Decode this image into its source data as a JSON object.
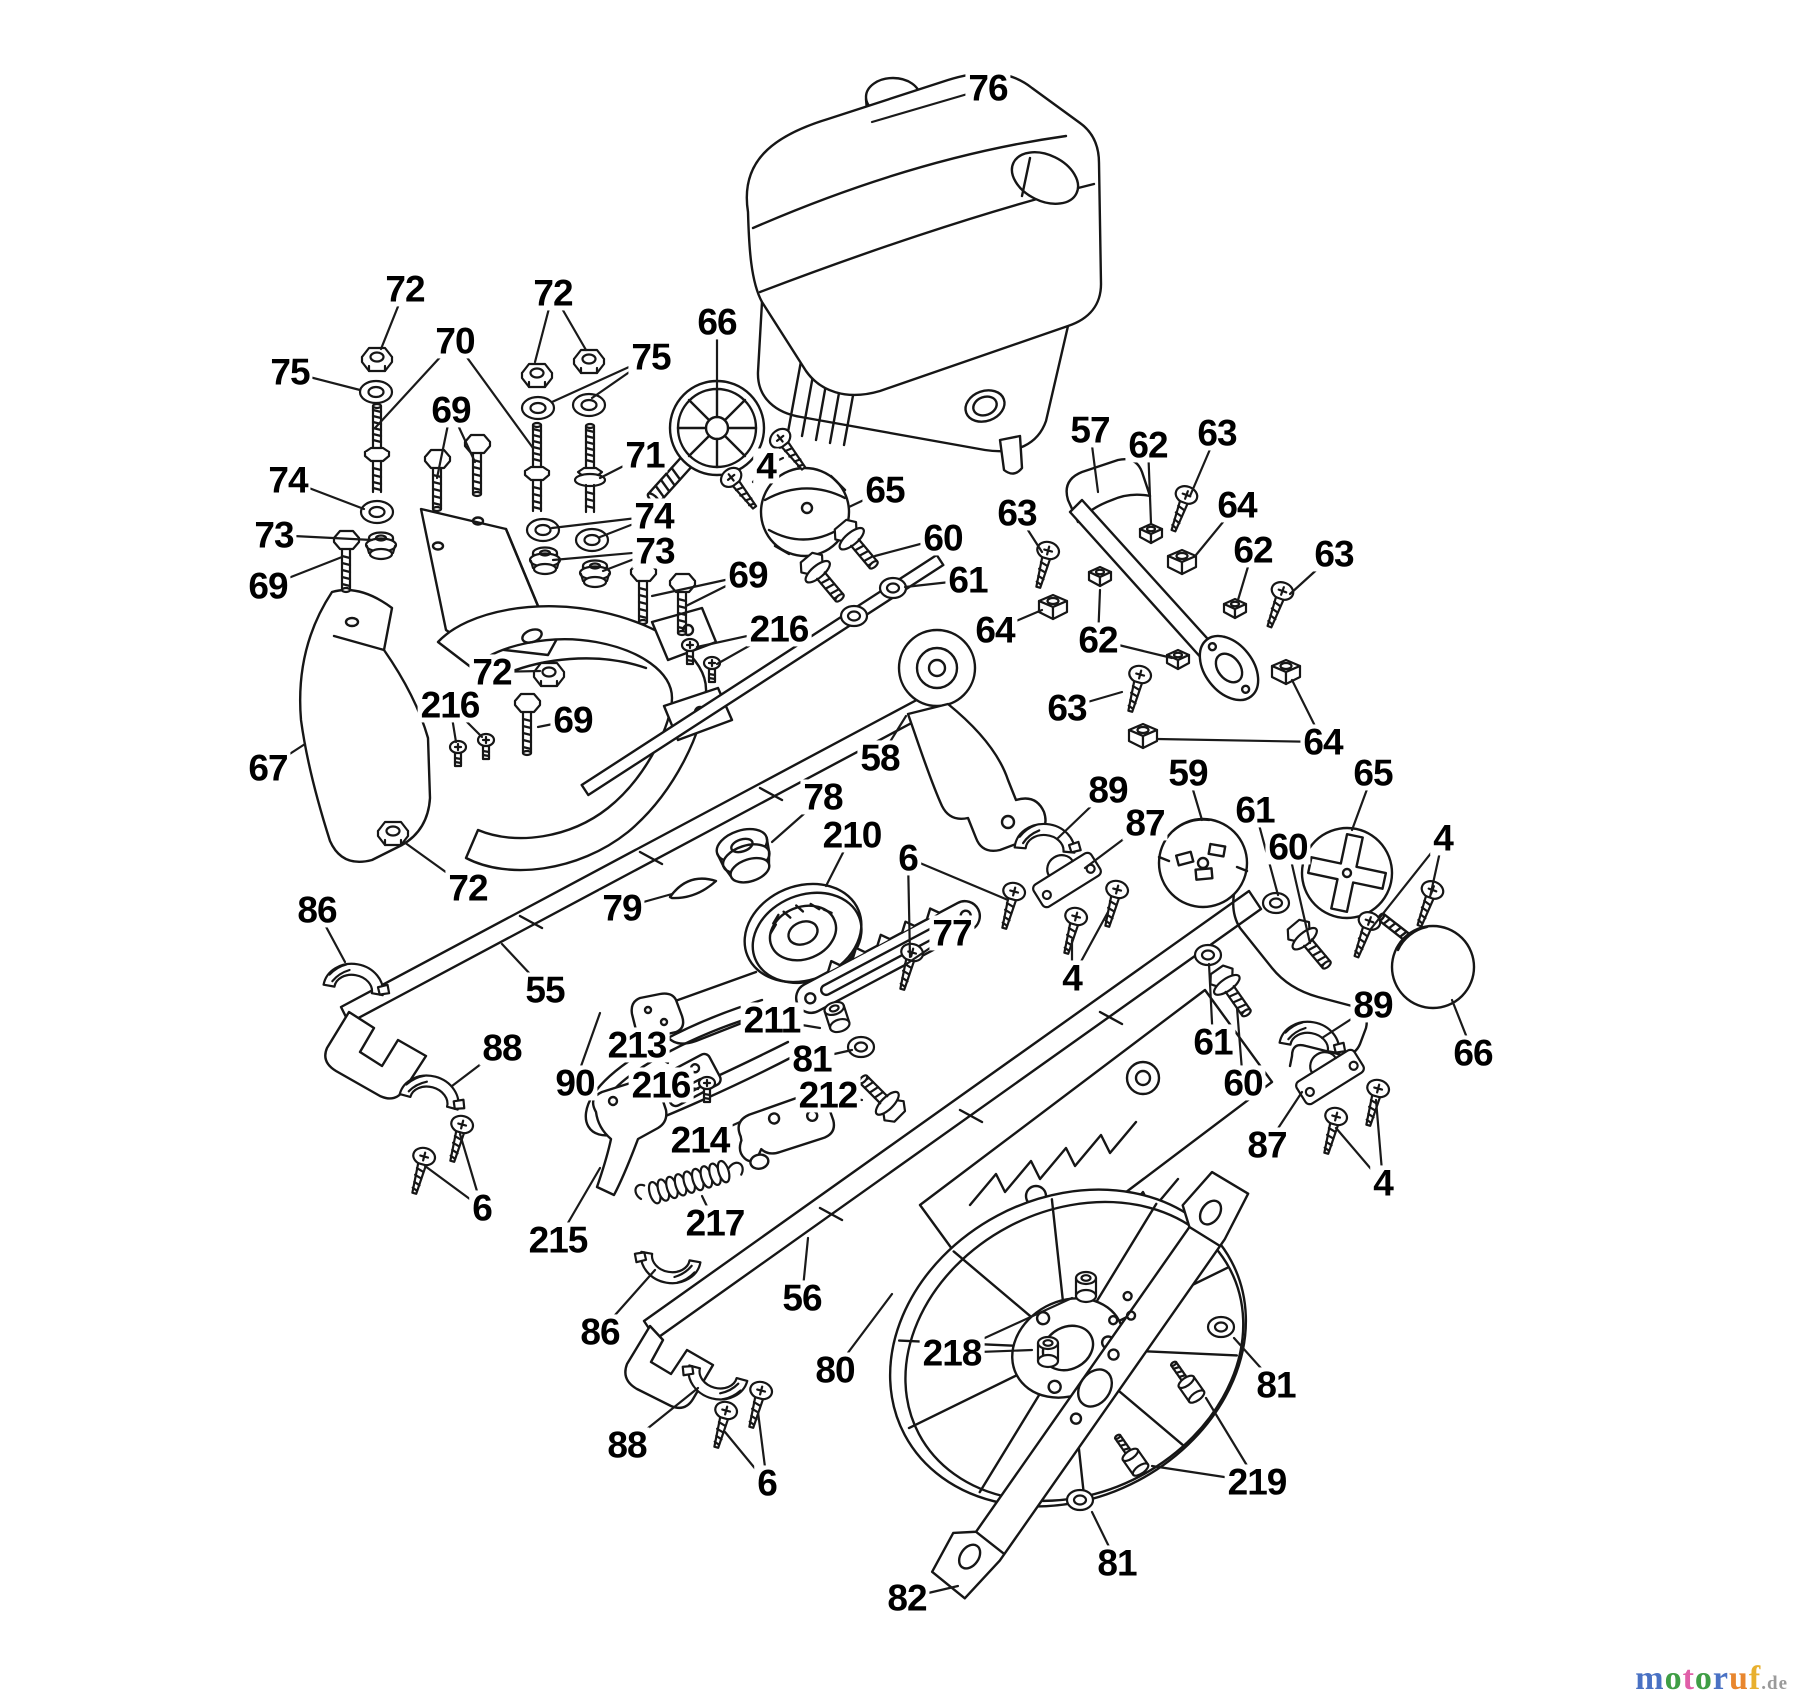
{
  "canvas": {
    "width": 1800,
    "height": 1704,
    "background": "#ffffff",
    "ink": "#161616"
  },
  "watermark": {
    "suffix": ".de",
    "suffix_color": "#9a9a9a",
    "letters": [
      {
        "ch": "m",
        "color": "#4a72c4"
      },
      {
        "ch": "o",
        "color": "#3f9e45"
      },
      {
        "ch": "t",
        "color": "#e05fa8"
      },
      {
        "ch": "o",
        "color": "#3f9e45"
      },
      {
        "ch": "r",
        "color": "#4a72c4"
      },
      {
        "ch": "u",
        "color": "#e8862e"
      },
      {
        "ch": "f",
        "color": "#e8b02e"
      }
    ]
  },
  "callouts": [
    {
      "n": "76",
      "x": 988,
      "y": 88,
      "t": [
        [
          872,
          122
        ]
      ]
    },
    {
      "n": "72",
      "x": 405,
      "y": 289,
      "t": [
        [
          381,
          349
        ]
      ]
    },
    {
      "n": "75",
      "x": 290,
      "y": 372,
      "t": [
        [
          360,
          390
        ]
      ]
    },
    {
      "n": "70",
      "x": 455,
      "y": 341,
      "t": [
        [
          375,
          428
        ],
        [
          533,
          448
        ]
      ]
    },
    {
      "n": "72",
      "x": 553,
      "y": 293,
      "t": [
        [
          535,
          362
        ],
        [
          586,
          350
        ]
      ]
    },
    {
      "n": "75",
      "x": 651,
      "y": 357,
      "t": [
        [
          552,
          402
        ],
        [
          592,
          398
        ]
      ]
    },
    {
      "n": "69",
      "x": 451,
      "y": 410,
      "t": [
        [
          437,
          478
        ],
        [
          475,
          462
        ]
      ]
    },
    {
      "n": "71",
      "x": 645,
      "y": 455,
      "t": [
        [
          600,
          478
        ]
      ]
    },
    {
      "n": "74",
      "x": 288,
      "y": 480,
      "t": [
        [
          364,
          509
        ]
      ]
    },
    {
      "n": "73",
      "x": 274,
      "y": 535,
      "t": [
        [
          372,
          540
        ]
      ]
    },
    {
      "n": "69",
      "x": 268,
      "y": 586,
      "t": [
        [
          342,
          557
        ]
      ]
    },
    {
      "n": "74",
      "x": 654,
      "y": 516,
      "t": [
        [
          600,
          537
        ],
        [
          552,
          528
        ]
      ]
    },
    {
      "n": "73",
      "x": 655,
      "y": 551,
      "t": [
        [
          603,
          571
        ],
        [
          553,
          560
        ]
      ]
    },
    {
      "n": "66",
      "x": 717,
      "y": 322,
      "t": [
        [
          717,
          388
        ]
      ]
    },
    {
      "n": "4",
      "x": 766,
      "y": 466,
      "t": [
        [
          753,
          482
        ],
        [
          783,
          458
        ]
      ]
    },
    {
      "n": "65",
      "x": 885,
      "y": 490,
      "t": [
        [
          849,
          507
        ]
      ]
    },
    {
      "n": "57",
      "x": 1090,
      "y": 430,
      "t": [
        [
          1098,
          492
        ]
      ]
    },
    {
      "n": "62",
      "x": 1148,
      "y": 445,
      "t": [
        [
          1151,
          523
        ]
      ]
    },
    {
      "n": "63",
      "x": 1217,
      "y": 433,
      "t": [
        [
          1190,
          496
        ]
      ]
    },
    {
      "n": "64",
      "x": 1237,
      "y": 505,
      "t": [
        [
          1196,
          555
        ]
      ]
    },
    {
      "n": "62",
      "x": 1253,
      "y": 550,
      "t": [
        [
          1238,
          600
        ]
      ]
    },
    {
      "n": "63",
      "x": 1334,
      "y": 554,
      "t": [
        [
          1290,
          594
        ]
      ]
    },
    {
      "n": "63",
      "x": 1017,
      "y": 513,
      "t": [
        [
          1042,
          552
        ]
      ]
    },
    {
      "n": "60",
      "x": 943,
      "y": 538,
      "t": [
        [
          875,
          556
        ]
      ]
    },
    {
      "n": "61",
      "x": 968,
      "y": 580,
      "t": [
        [
          905,
          587
        ]
      ]
    },
    {
      "n": "64",
      "x": 995,
      "y": 630,
      "t": [
        [
          1042,
          610
        ]
      ]
    },
    {
      "n": "62",
      "x": 1098,
      "y": 640,
      "t": [
        [
          1100,
          590
        ],
        [
          1172,
          658
        ]
      ]
    },
    {
      "n": "63",
      "x": 1067,
      "y": 708,
      "t": [
        [
          1122,
          692
        ]
      ]
    },
    {
      "n": "64",
      "x": 1323,
      "y": 742,
      "t": [
        [
          1292,
          680
        ],
        [
          1157,
          739
        ]
      ]
    },
    {
      "n": "67",
      "x": 268,
      "y": 768,
      "t": [
        [
          305,
          744
        ]
      ]
    },
    {
      "n": "72",
      "x": 492,
      "y": 672,
      "t": [
        [
          540,
          671
        ]
      ]
    },
    {
      "n": "216",
      "x": 450,
      "y": 705,
      "t": [
        [
          456,
          742
        ],
        [
          482,
          737
        ]
      ]
    },
    {
      "n": "69",
      "x": 573,
      "y": 720,
      "t": [
        [
          538,
          727
        ]
      ]
    },
    {
      "n": "69",
      "x": 748,
      "y": 575,
      "t": [
        [
          652,
          596
        ],
        [
          686,
          606
        ]
      ]
    },
    {
      "n": "216",
      "x": 779,
      "y": 629,
      "t": [
        [
          697,
          647
        ],
        [
          717,
          664
        ]
      ]
    },
    {
      "n": "72",
      "x": 468,
      "y": 888,
      "t": [
        [
          404,
          842
        ]
      ]
    },
    {
      "n": "86",
      "x": 317,
      "y": 910,
      "t": [
        [
          345,
          962
        ]
      ]
    },
    {
      "n": "79",
      "x": 622,
      "y": 908,
      "t": [
        [
          672,
          894
        ]
      ]
    },
    {
      "n": "55",
      "x": 545,
      "y": 990,
      "t": [
        [
          502,
          944
        ]
      ]
    },
    {
      "n": "58",
      "x": 880,
      "y": 758,
      "t": [
        [
          906,
          716
        ]
      ]
    },
    {
      "n": "78",
      "x": 823,
      "y": 797,
      "t": [
        [
          772,
          842
        ]
      ]
    },
    {
      "n": "210",
      "x": 852,
      "y": 835,
      "t": [
        [
          826,
          886
        ]
      ]
    },
    {
      "n": "6",
      "x": 908,
      "y": 858,
      "t": [
        [
          910,
          957
        ],
        [
          1008,
          900
        ]
      ]
    },
    {
      "n": "77",
      "x": 952,
      "y": 933,
      "t": [
        [
          905,
          965
        ]
      ]
    },
    {
      "n": "211",
      "x": 772,
      "y": 1020,
      "t": [
        [
          820,
          1028
        ]
      ]
    },
    {
      "n": "81",
      "x": 812,
      "y": 1059,
      "t": [
        [
          852,
          1050
        ]
      ]
    },
    {
      "n": "213",
      "x": 637,
      "y": 1045,
      "t": [
        [
          668,
          1063
        ]
      ]
    },
    {
      "n": "90",
      "x": 575,
      "y": 1083,
      "t": [
        [
          600,
          1013
        ]
      ]
    },
    {
      "n": "216",
      "x": 661,
      "y": 1085,
      "t": [
        [
          698,
          1089
        ]
      ]
    },
    {
      "n": "212",
      "x": 828,
      "y": 1095,
      "t": [
        [
          862,
          1100
        ]
      ]
    },
    {
      "n": "214",
      "x": 700,
      "y": 1140,
      "t": [
        [
          740,
          1122
        ]
      ]
    },
    {
      "n": "215",
      "x": 558,
      "y": 1240,
      "t": [
        [
          600,
          1168
        ]
      ]
    },
    {
      "n": "217",
      "x": 715,
      "y": 1223,
      "t": [
        [
          702,
          1196
        ]
      ]
    },
    {
      "n": "6",
      "x": 482,
      "y": 1208,
      "t": [
        [
          425,
          1166
        ],
        [
          460,
          1134
        ]
      ]
    },
    {
      "n": "86",
      "x": 600,
      "y": 1332,
      "t": [
        [
          655,
          1270
        ]
      ]
    },
    {
      "n": "56",
      "x": 802,
      "y": 1298,
      "t": [
        [
          808,
          1238
        ]
      ]
    },
    {
      "n": "80",
      "x": 835,
      "y": 1370,
      "t": [
        [
          892,
          1294
        ]
      ]
    },
    {
      "n": "218",
      "x": 952,
      "y": 1353,
      "t": [
        [
          1032,
          1350
        ],
        [
          1072,
          1298
        ]
      ]
    },
    {
      "n": "88",
      "x": 502,
      "y": 1048,
      "t": [
        [
          452,
          1086
        ]
      ]
    },
    {
      "n": "88",
      "x": 627,
      "y": 1445,
      "t": [
        [
          698,
          1388
        ]
      ]
    },
    {
      "n": "6",
      "x": 767,
      "y": 1483,
      "t": [
        [
          725,
          1432
        ],
        [
          758,
          1412
        ]
      ]
    },
    {
      "n": "82",
      "x": 907,
      "y": 1598,
      "t": [
        [
          958,
          1586
        ]
      ]
    },
    {
      "n": "81",
      "x": 1276,
      "y": 1385,
      "t": [
        [
          1234,
          1338
        ]
      ]
    },
    {
      "n": "219",
      "x": 1257,
      "y": 1482,
      "t": [
        [
          1206,
          1398
        ],
        [
          1152,
          1466
        ]
      ]
    },
    {
      "n": "81",
      "x": 1117,
      "y": 1563,
      "t": [
        [
          1092,
          1512
        ]
      ]
    },
    {
      "n": "59",
      "x": 1188,
      "y": 773,
      "t": [
        [
          1202,
          820
        ]
      ]
    },
    {
      "n": "89",
      "x": 1108,
      "y": 790,
      "t": [
        [
          1058,
          838
        ]
      ]
    },
    {
      "n": "87",
      "x": 1145,
      "y": 823,
      "t": [
        [
          1085,
          868
        ]
      ]
    },
    {
      "n": "61",
      "x": 1255,
      "y": 810,
      "t": [
        [
          1278,
          895
        ]
      ]
    },
    {
      "n": "60",
      "x": 1288,
      "y": 847,
      "t": [
        [
          1310,
          943
        ]
      ]
    },
    {
      "n": "65",
      "x": 1373,
      "y": 773,
      "t": [
        [
          1352,
          830
        ]
      ]
    },
    {
      "n": "4",
      "x": 1443,
      "y": 838,
      "t": [
        [
          1430,
          897
        ],
        [
          1370,
          930
        ]
      ]
    },
    {
      "n": "4",
      "x": 1072,
      "y": 978,
      "t": [
        [
          1072,
          940
        ],
        [
          1108,
          912
        ]
      ]
    },
    {
      "n": "61",
      "x": 1213,
      "y": 1042,
      "t": [
        [
          1209,
          964
        ]
      ]
    },
    {
      "n": "60",
      "x": 1243,
      "y": 1083,
      "t": [
        [
          1237,
          1008
        ]
      ]
    },
    {
      "n": "89",
      "x": 1373,
      "y": 1005,
      "t": [
        [
          1322,
          1038
        ]
      ]
    },
    {
      "n": "87",
      "x": 1267,
      "y": 1145,
      "t": [
        [
          1302,
          1092
        ]
      ]
    },
    {
      "n": "4",
      "x": 1383,
      "y": 1183,
      "t": [
        [
          1336,
          1128
        ],
        [
          1376,
          1100
        ]
      ]
    },
    {
      "n": "66",
      "x": 1473,
      "y": 1053,
      "t": [
        [
          1452,
          1000
        ]
      ]
    }
  ],
  "fasteners": [
    {
      "t": "hexnut",
      "x": 377,
      "y": 360,
      "r": 0
    },
    {
      "t": "hexnut",
      "x": 537,
      "y": 376,
      "r": 0
    },
    {
      "t": "hexnut",
      "x": 589,
      "y": 362,
      "r": 0
    },
    {
      "t": "hexnut",
      "x": 549,
      "y": 675,
      "r": 0
    },
    {
      "t": "hexnut",
      "x": 393,
      "y": 834,
      "r": 0
    },
    {
      "t": "sqnut",
      "x": 1151,
      "y": 535,
      "r": 0
    },
    {
      "t": "sqnut",
      "x": 1235,
      "y": 610,
      "r": 0
    },
    {
      "t": "sqnut",
      "x": 1100,
      "y": 578,
      "r": 0
    },
    {
      "t": "sqnut",
      "x": 1178,
      "y": 661,
      "r": 0
    },
    {
      "t": "sqnut64",
      "x": 1182,
      "y": 564,
      "r": 0
    },
    {
      "t": "sqnut64",
      "x": 1053,
      "y": 609,
      "r": 0
    },
    {
      "t": "sqnut64",
      "x": 1286,
      "y": 674,
      "r": 0
    },
    {
      "t": "sqnut64",
      "x": 1143,
      "y": 738,
      "r": 0
    },
    {
      "t": "washer",
      "x": 376,
      "y": 392,
      "r": 0
    },
    {
      "t": "washer",
      "x": 538,
      "y": 408,
      "r": 0
    },
    {
      "t": "washer",
      "x": 589,
      "y": 405,
      "r": 0
    },
    {
      "t": "washer",
      "x": 543,
      "y": 530,
      "r": 0
    },
    {
      "t": "washer",
      "x": 592,
      "y": 540,
      "r": 0
    },
    {
      "t": "washer",
      "x": 377,
      "y": 512,
      "r": 0
    },
    {
      "t": "washer_s",
      "x": 893,
      "y": 588,
      "r": 0
    },
    {
      "t": "washer_s",
      "x": 854,
      "y": 616,
      "r": 0
    },
    {
      "t": "washer_s",
      "x": 1276,
      "y": 903,
      "r": 0
    },
    {
      "t": "washer_s",
      "x": 1208,
      "y": 955,
      "r": 0
    },
    {
      "t": "washer_s",
      "x": 861,
      "y": 1047,
      "r": 0
    },
    {
      "t": "washer_s",
      "x": 1221,
      "y": 1327,
      "r": 0
    },
    {
      "t": "washer_s",
      "x": 1080,
      "y": 1500,
      "r": 0
    },
    {
      "t": "grommet",
      "x": 381,
      "y": 547,
      "r": 0
    },
    {
      "t": "grommet",
      "x": 545,
      "y": 562,
      "r": 0
    },
    {
      "t": "grommet",
      "x": 595,
      "y": 575,
      "r": 0
    },
    {
      "t": "bushing",
      "x": 1086,
      "y": 1287,
      "r": 0
    },
    {
      "t": "bushing",
      "x": 1048,
      "y": 1352,
      "r": 0
    },
    {
      "t": "bushing",
      "x": 837,
      "y": 1017,
      "r": -18
    },
    {
      "t": "stud",
      "x": 377,
      "y": 448,
      "r": 0
    },
    {
      "t": "stud",
      "x": 537,
      "y": 467,
      "r": 0
    },
    {
      "t": "stud71",
      "x": 590,
      "y": 468,
      "r": 0
    },
    {
      "t": "hexbolt",
      "x": 437,
      "y": 487,
      "r": 0
    },
    {
      "t": "hexbolt",
      "x": 477,
      "y": 472,
      "r": 0
    },
    {
      "t": "hexbolt",
      "x": 346,
      "y": 568,
      "r": 0
    },
    {
      "t": "hexbolt",
      "x": 643,
      "y": 600,
      "r": 0
    },
    {
      "t": "hexbolt",
      "x": 682,
      "y": 611,
      "r": 0
    },
    {
      "t": "hexbolt",
      "x": 527,
      "y": 731,
      "r": 0
    },
    {
      "t": "flangebolt",
      "x": 862,
      "y": 551,
      "r": -40
    },
    {
      "t": "flangebolt",
      "x": 828,
      "y": 584,
      "r": -40
    },
    {
      "t": "flangebolt",
      "x": 1315,
      "y": 951,
      "r": -40
    },
    {
      "t": "flangebolt",
      "x": 1236,
      "y": 998,
      "r": -35
    },
    {
      "t": "flangebolt",
      "x": 876,
      "y": 1092,
      "r": 135
    },
    {
      "t": "screw",
      "x": 1181,
      "y": 510,
      "r": 20
    },
    {
      "t": "screw",
      "x": 1277,
      "y": 606,
      "r": 20
    },
    {
      "t": "screw",
      "x": 1044,
      "y": 566,
      "r": 15
    },
    {
      "t": "screw",
      "x": 1136,
      "y": 690,
      "r": 15
    },
    {
      "t": "screw",
      "x": 741,
      "y": 490,
      "r": -38
    },
    {
      "t": "screw",
      "x": 790,
      "y": 451,
      "r": -38
    },
    {
      "t": "screw",
      "x": 908,
      "y": 968,
      "r": 15
    },
    {
      "t": "screw",
      "x": 1010,
      "y": 907,
      "r": 15
    },
    {
      "t": "screw",
      "x": 1072,
      "y": 932,
      "r": 15
    },
    {
      "t": "screw",
      "x": 1113,
      "y": 905,
      "r": 15
    },
    {
      "t": "screw",
      "x": 1427,
      "y": 905,
      "r": 20
    },
    {
      "t": "screw",
      "x": 1364,
      "y": 936,
      "r": 20
    },
    {
      "t": "screw",
      "x": 1332,
      "y": 1132,
      "r": 15
    },
    {
      "t": "screw",
      "x": 1374,
      "y": 1104,
      "r": 15
    },
    {
      "t": "screw",
      "x": 420,
      "y": 1172,
      "r": 15
    },
    {
      "t": "screw",
      "x": 458,
      "y": 1140,
      "r": 15
    },
    {
      "t": "screw",
      "x": 722,
      "y": 1426,
      "r": 15
    },
    {
      "t": "screw",
      "x": 757,
      "y": 1406,
      "r": 15
    },
    {
      "t": "rivet",
      "x": 458,
      "y": 754,
      "r": 0
    },
    {
      "t": "rivet",
      "x": 486,
      "y": 747,
      "r": 0
    },
    {
      "t": "rivet",
      "x": 690,
      "y": 652,
      "r": 0
    },
    {
      "t": "rivet",
      "x": 712,
      "y": 670,
      "r": 0
    },
    {
      "t": "rivet",
      "x": 707,
      "y": 1090,
      "r": 0
    },
    {
      "t": "shoulder",
      "x": 1192,
      "y": 1390,
      "r": -35
    },
    {
      "t": "shoulder",
      "x": 1136,
      "y": 1463,
      "r": -35
    },
    {
      "t": "spring",
      "x": 693,
      "y": 1181,
      "r": -17
    },
    {
      "t": "clamp",
      "x": 354,
      "y": 985,
      "r": 10
    },
    {
      "t": "clamp",
      "x": 670,
      "y": 1262,
      "r": 190
    },
    {
      "t": "clamp",
      "x": 430,
      "y": 1097,
      "r": 15
    },
    {
      "t": "clamp",
      "x": 717,
      "y": 1378,
      "r": 195
    },
    {
      "t": "clamp",
      "x": 1045,
      "y": 845,
      "r": 5
    },
    {
      "t": "clamp",
      "x": 1310,
      "y": 1043,
      "r": 10
    },
    {
      "t": "block",
      "x": 1067,
      "y": 880,
      "r": -32
    },
    {
      "t": "block",
      "x": 1330,
      "y": 1077,
      "r": -32
    }
  ]
}
